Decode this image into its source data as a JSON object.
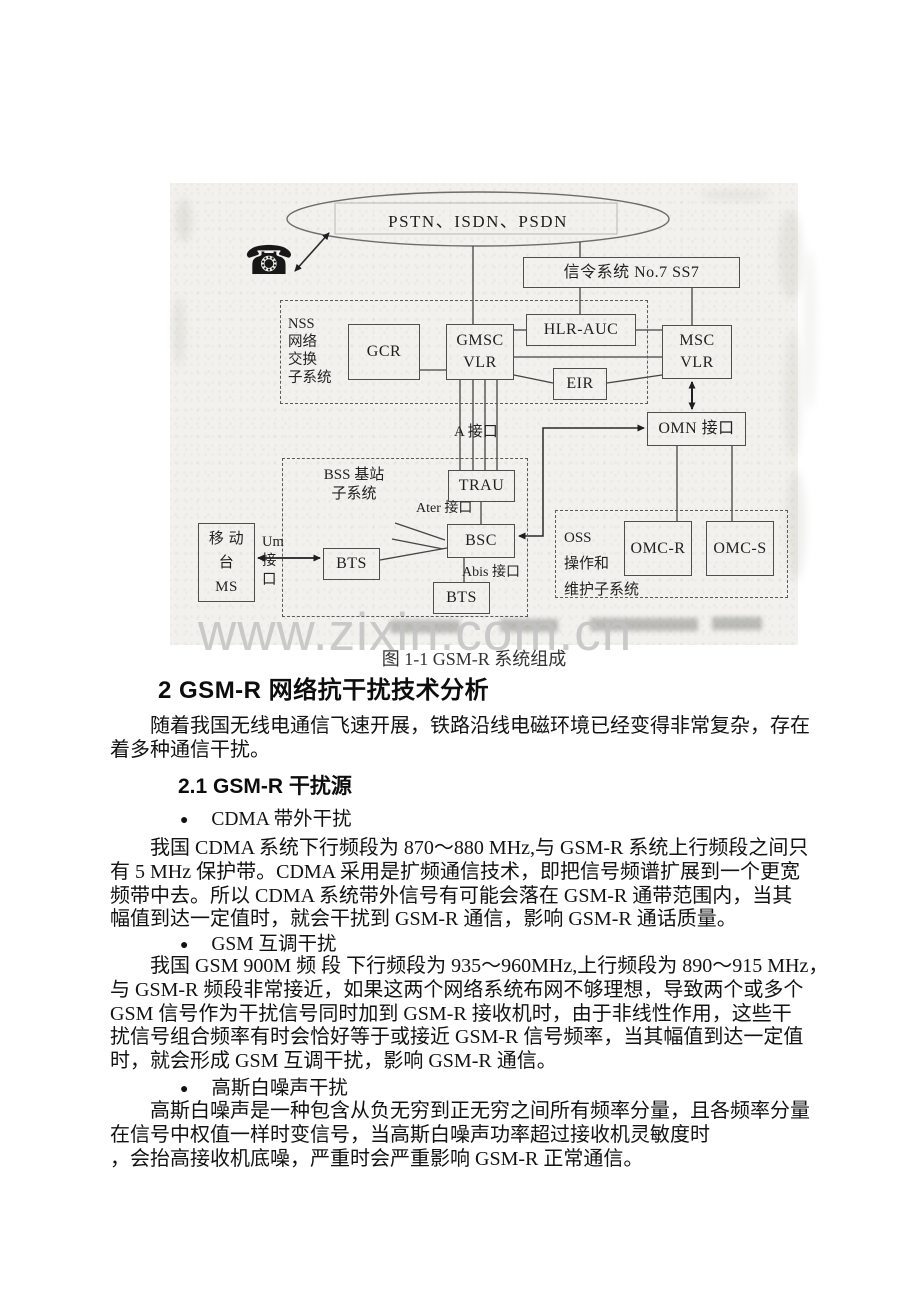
{
  "watermark": "www.zixin.com.cn",
  "caption": "图 1-1 GSM-R 系统组成",
  "colors": {
    "scan_bg": "#f2f1ed",
    "watermark": "#c3c3c3",
    "ink": "#1c1c1c"
  },
  "diagram": {
    "phone_glyph": "☎",
    "cloud_label": "PSTN、ISDN、PSDN",
    "ss7": "信令系统 No.7 SS7",
    "nss": {
      "l1": "NSS",
      "l2": "网络",
      "l3": "交换",
      "l4": "子系统"
    },
    "gcr": "GCR",
    "gmsc": {
      "l1": "GMSC",
      "l2": "VLR"
    },
    "hlr": "HLR-AUC",
    "eir": "EIR",
    "msc": {
      "l1": "MSC",
      "l2": "VLR"
    },
    "a_if": "A 接口",
    "omn": "OMN 接口",
    "bss": {
      "l1": "BSS 基站",
      "l2": "子系统"
    },
    "trau": "TRAU",
    "ater_if": "Ater 接口",
    "bsc": "BSC",
    "abis_if": "Abis 接口",
    "bts1": "BTS",
    "bts2": "BTS",
    "ms": {
      "l1": "移 动",
      "l2": "台",
      "l3": "MS"
    },
    "um": {
      "l1": "Um",
      "l2": "接",
      "l3": "口"
    },
    "oss": {
      "l1": "OSS",
      "l2": "操作和",
      "l3": "维护子系统"
    },
    "omcr": "OMC-R",
    "omcs": "OMC-S"
  },
  "content": {
    "heading": "2 GSM-R 网络抗干扰技术分析",
    "intro": [
      "随着我国无线电通信飞速开展，铁路沿线电磁环境已经变得非常复杂，存在",
      "着多种通信干扰。"
    ],
    "subheading": "2.1 GSM-R 干扰源",
    "bullet_glyph": "●",
    "sections": [
      {
        "label": "CDMA 带外干扰",
        "lines": [
          "我国 CDMA 系统下行频段为 870～880 MHz,与 GSM-R 系统上行频段之间只",
          "有 5 MHz 保护带。CDMA 采用是扩频通信技术，即把信号频谱扩展到一个更宽",
          "频带中去。所以 CDMA 系统带外信号有可能会落在 GSM-R 通带范围内，当其",
          "幅值到达一定值时，就会干扰到 GSM-R 通信，影响 GSM-R 通话质量。"
        ]
      },
      {
        "label": "GSM 互调干扰",
        "lines": [
          "我国 GSM 900M 频 段 下行频段为 935～960MHz,上行频段为 890～915 MHz，",
          "与 GSM-R 频段非常接近，如果这两个网络系统布网不够理想，导致两个或多个",
          "GSM 信号作为干扰信号同时加到 GSM-R 接收机时，由于非线性作用，这些干",
          "扰信号组合频率有时会恰好等于或接近 GSM-R 信号频率，当其幅值到达一定值",
          "时，就会形成 GSM 互调干扰，影响 GSM-R 通信。"
        ]
      },
      {
        "label": "高斯白噪声干扰",
        "lines": [
          "高斯白噪声是一种包含从负无穷到正无穷之间所有频率分量，且各频率分量",
          "在信号中权值一样时变信号，当高斯白噪声功率超过接收机灵敏度时",
          "，会抬高接收机底噪，严重时会严重影响 GSM-R 正常通信。"
        ]
      }
    ]
  }
}
